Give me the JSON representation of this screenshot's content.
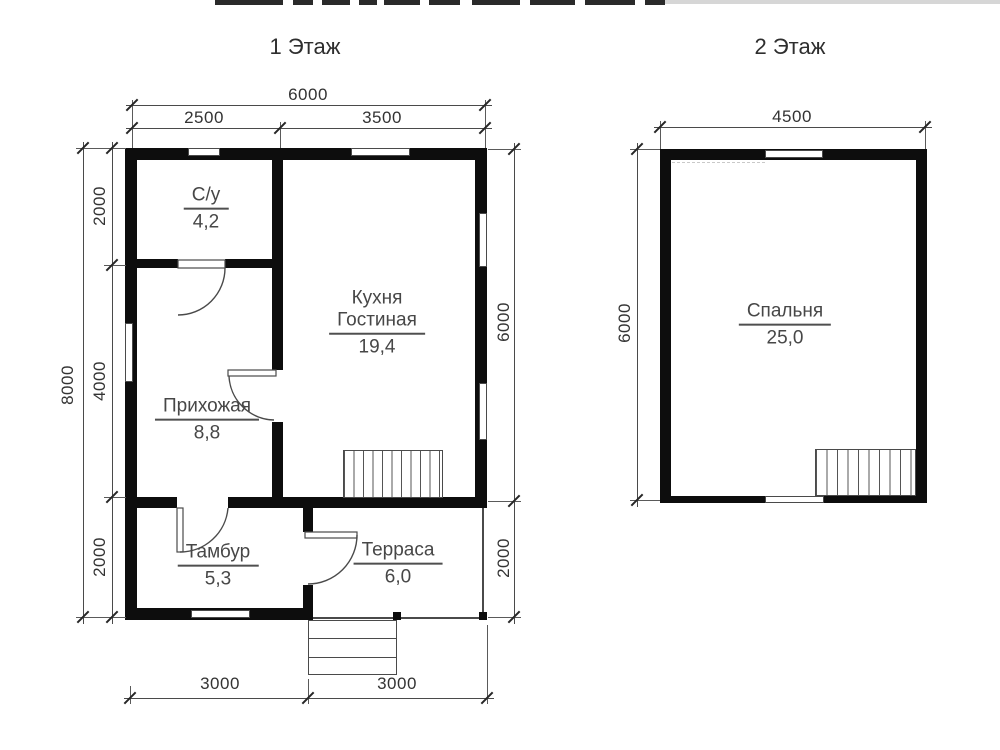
{
  "floor1": {
    "title": "1 Этаж",
    "rooms": {
      "bathroom": {
        "name": "С/у",
        "area": "4,2"
      },
      "kitchen": {
        "name_line1": "Кухня",
        "name_line2": "Гостиная",
        "area": "19,4"
      },
      "hallway": {
        "name": "Прихожая",
        "area": "8,8"
      },
      "vestibule": {
        "name": "Тамбур",
        "area": "5,3"
      },
      "terrace": {
        "name": "Терраса",
        "area": "6,0"
      }
    },
    "dims": {
      "top_total": "6000",
      "top_left": "2500",
      "top_right": "3500",
      "left_total": "8000",
      "left_top": "2000",
      "left_middle": "4000",
      "left_bottom": "2000",
      "right_top": "6000",
      "right_bottom": "2000",
      "bottom_left": "3000",
      "bottom_right": "3000"
    }
  },
  "floor2": {
    "title": "2 Этаж",
    "rooms": {
      "bedroom": {
        "name": "Спальня",
        "area": "25,0"
      }
    },
    "dims": {
      "top_total": "4500",
      "left_total": "6000"
    }
  },
  "colors": {
    "wall": "#0d0d0d",
    "line": "#4a4a4a",
    "text": "#333333"
  }
}
